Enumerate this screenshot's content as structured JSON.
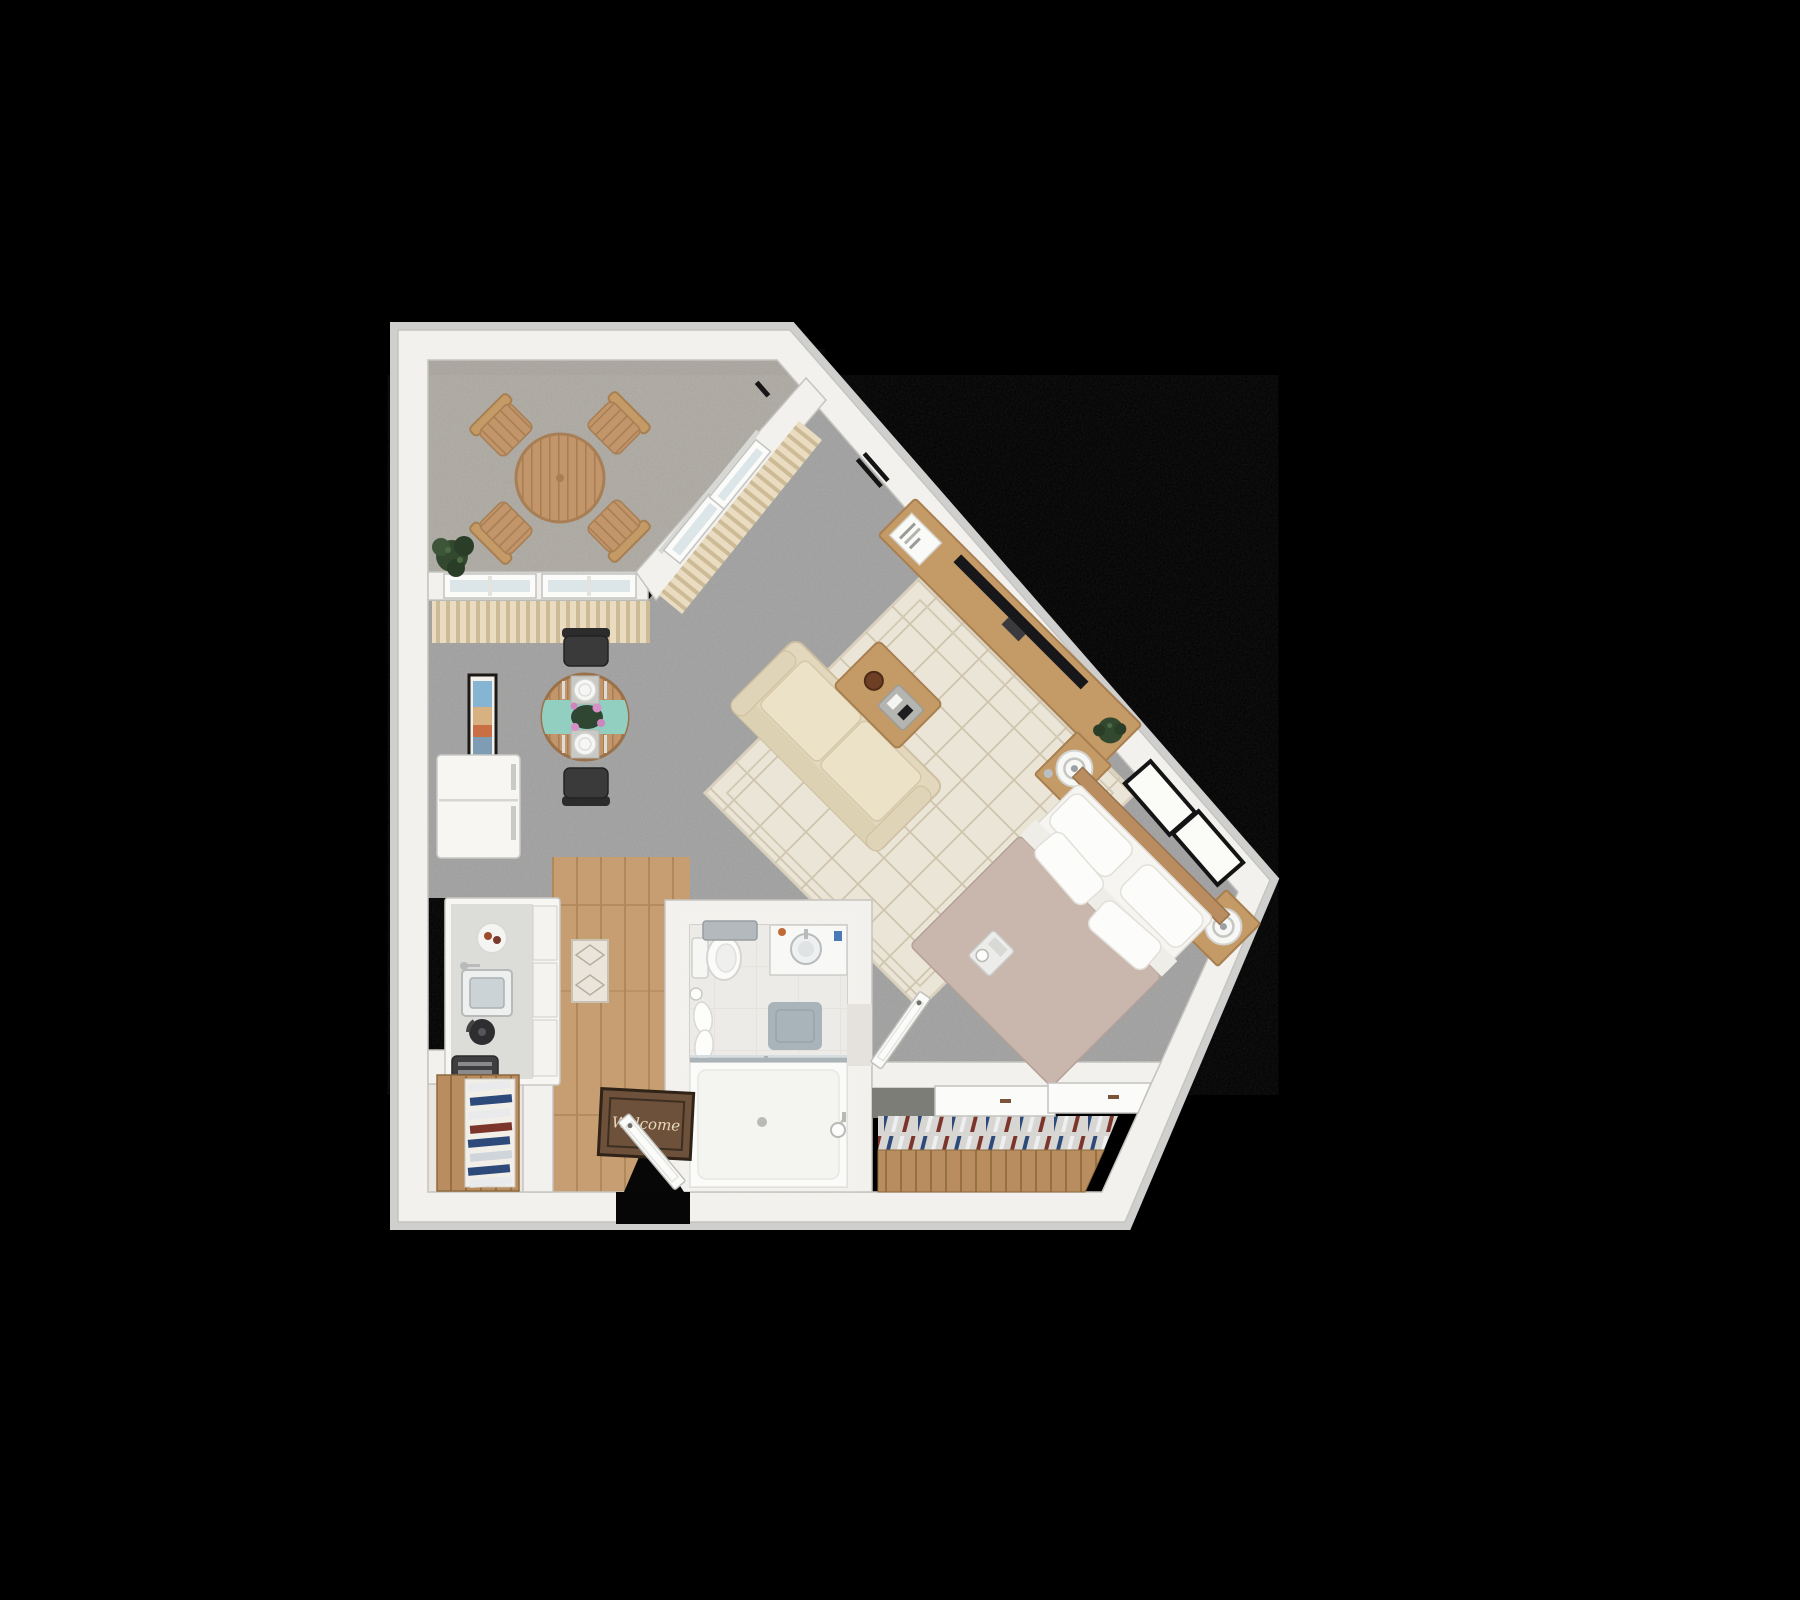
{
  "canvas": {
    "width": 1800,
    "height": 1600,
    "background": "#000000"
  },
  "doormat": {
    "text": "Welcome"
  },
  "colors": {
    "background": "#000000",
    "wall": "#f3f1ed",
    "wall_edge": "#c6c4c0",
    "outer_rim": "#cfcfcd",
    "carpet": "#9d9d9d",
    "balcony_floor": "#a6a29b",
    "wood_floor": "#c79e71",
    "bathroom_floor": "#eceae6",
    "nook_floor": "#e9e4dc",
    "rug": "#ebe5d7",
    "rug_pattern": "#cfc5ae",
    "sofa": "#e3d8bd",
    "sofa_cushion": "#ece2c8",
    "bed_duvet": "#c9b7ae",
    "bed_sheet": "#f6f5f2",
    "wood_furniture": "#c49a66",
    "headboard": "#b98d5f",
    "teal_runner": "#93cfc1",
    "blinds": "#e9dcc0",
    "tv": "#17171a",
    "plant": "#33492f",
    "doormat_fill": "#6e513a",
    "glass": "#dce5e8",
    "bath_mat": "#a9b3ba",
    "towel": "#b3b9bd",
    "closet_wood": "#b98d5f",
    "hanger_navy": "#2d4a7a",
    "hanger_white": "#edeff1",
    "hanger_red": "#7c352b"
  },
  "rooms": {
    "balcony": {
      "name": "balcony",
      "items": [
        "round slatted patio table",
        "patio chair x4",
        "potted plant",
        "sliding glass door",
        "windows with vertical blinds"
      ]
    },
    "living_room": {
      "name": "living room",
      "items": [
        "loveseat sofa",
        "diamond pattern area rug",
        "coffee table with tray",
        "media console",
        "flat tv",
        "magazine",
        "potted plant",
        "round dining table",
        "black dining chair x2",
        "teal table runner",
        "wall art"
      ]
    },
    "sleeping_area": {
      "name": "sleeping area",
      "items": [
        "double bed",
        "nightstand x2",
        "round table lamp x2",
        "black picture frame x2",
        "bed tray",
        "wall vent"
      ]
    },
    "kitchen": {
      "name": "kitchen",
      "items": [
        "refrigerator",
        "counter with sink",
        "kettle",
        "toaster",
        "serving plate",
        "kitchen mat"
      ]
    },
    "bathroom": {
      "name": "bathroom",
      "items": [
        "toilet",
        "towel rack",
        "hanging towels",
        "vanity with round sink",
        "bath mat",
        "tub shower with glass panel",
        "hand shower"
      ]
    },
    "entry": {
      "name": "entry",
      "items": [
        "welcome doormat",
        "open entry door",
        "shoe shelf"
      ]
    },
    "closet": {
      "name": "closet",
      "items": [
        "sliding closet doors",
        "hanging clothes",
        "wood shelf front"
      ]
    }
  }
}
